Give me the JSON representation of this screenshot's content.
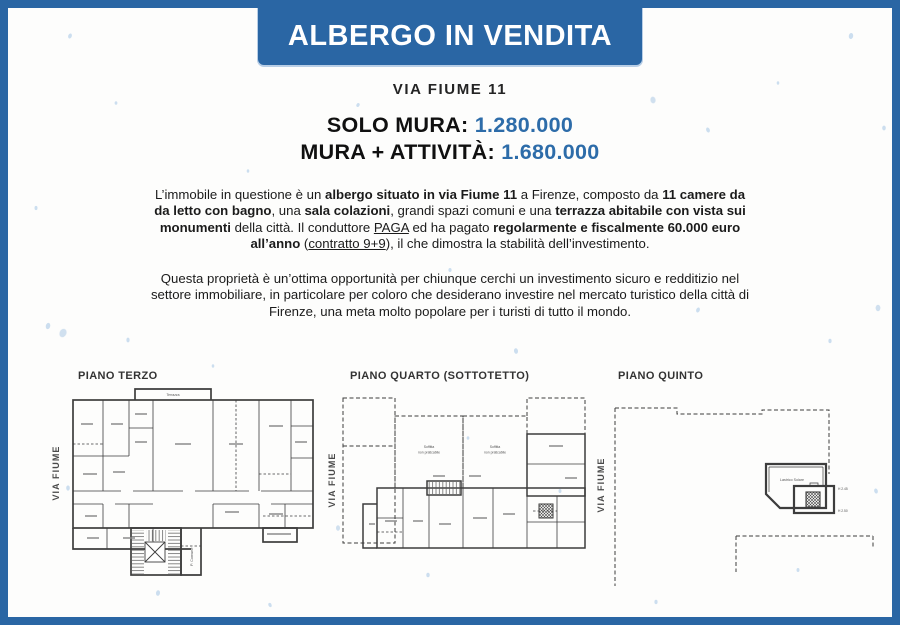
{
  "colors": {
    "brand_blue": "#2A66A4",
    "price_blue": "#2D6CA9",
    "text_dark": "#1B1B1B",
    "speckle_blue": "#C7DBEE"
  },
  "header": {
    "title": "ALBERGO IN VENDITA",
    "address": "VIA FIUME 11"
  },
  "pricing": {
    "solo_mura_label": "SOLO MURA: ",
    "solo_mura_value": "1.280.000",
    "mura_attivita_label": "MURA + ATTIVITÀ: ",
    "mura_attivita_value": "1.680.000"
  },
  "description": {
    "paragraph1": [
      {
        "t": "L’immobile in questione è un "
      },
      {
        "t": "albergo situato in via Fiume 11",
        "b": true
      },
      {
        "t": " a Firenze, composto da "
      },
      {
        "t": "11 camere da da letto con bagno",
        "b": true
      },
      {
        "t": ", una "
      },
      {
        "t": "sala colazioni",
        "b": true
      },
      {
        "t": ", grandi spazi comuni e una "
      },
      {
        "t": "terrazza abitabile con vista sui monumenti",
        "b": true
      },
      {
        "t": " della città. Il conduttore "
      },
      {
        "t": "PAGA",
        "u": true
      },
      {
        "t": " ed ha pagato "
      },
      {
        "t": "regolarmente e fiscalmente 60.000 euro all’anno",
        "b": true
      },
      {
        "t": " ("
      },
      {
        "t": "contratto 9+9",
        "u": true
      },
      {
        "t": "), il che dimostra la stabilità dell’investimento."
      }
    ],
    "paragraph2": [
      {
        "t": "Questa proprietà è un’ottima opportunità per chiunque cerchi un investimento sicuro e redditizio nel settore immobiliare, in particolare per coloro che desiderano investire nel mercato turistico della città di Firenze, una meta molto popolare per i turisti di tutto il mondo."
      }
    ]
  },
  "plans": [
    {
      "title": "PIANO TERZO",
      "street": "VIA FIUME",
      "labels": {
        "terrace": "Terrazza",
        "stairwell": "P. Comune"
      }
    },
    {
      "title": "PIANO QUARTO (SOTTOTETTO)",
      "street": "VIA FIUME",
      "labels": {
        "attic_line1": "Soffitta",
        "attic_line2": "non praticabile"
      }
    },
    {
      "title": "PIANO QUINTO",
      "street": "VIA FIUME",
      "labels": {
        "roof": "Lastrico Solare",
        "h1": "H 2.45",
        "h2": "H 2.50"
      }
    }
  ]
}
